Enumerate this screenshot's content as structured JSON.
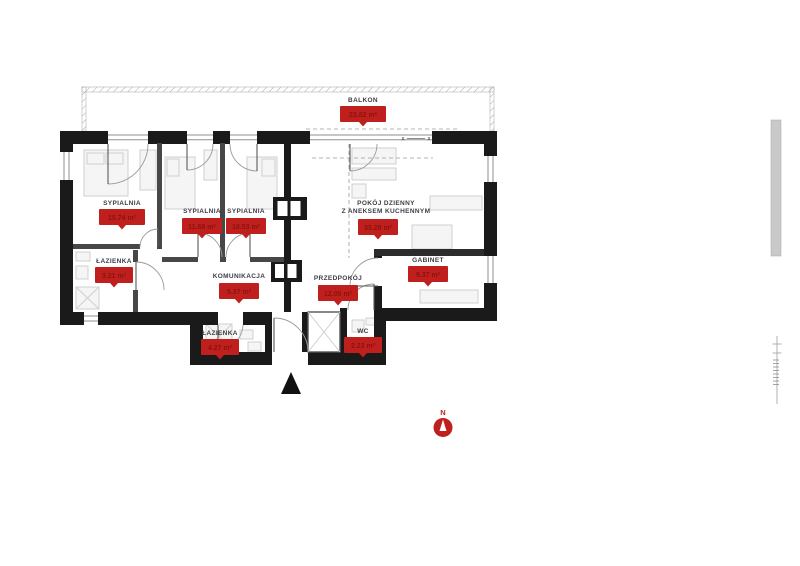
{
  "plan": {
    "colors": {
      "badge": "#c0201d",
      "badge_text": "#8a1310",
      "label_text": "#3d3d44",
      "wall": "#1a1a1a"
    },
    "rooms": [
      {
        "id": "balkon",
        "name": "BALKON",
        "area": "23.82 m²"
      },
      {
        "id": "sypialnia-1",
        "name": "SYPIALNIA",
        "area": "15.74 m²"
      },
      {
        "id": "sypialnia-2",
        "name": "SYPIALNIA",
        "area": "11.68 m²"
      },
      {
        "id": "sypialnia-3",
        "name": "SYPIALNIA",
        "area": "10.53 m²"
      },
      {
        "id": "pokoj-dzienny",
        "name_line1": "POKÓJ DZIENNY",
        "name_line2": "Z ANEKSEM KUCHENNYM",
        "area": "33.28 m²"
      },
      {
        "id": "lazienka-1",
        "name": "ŁAZIENKA",
        "area": "3.21 m²"
      },
      {
        "id": "komunikacja",
        "name": "KOMUNIKACJA",
        "area": "5.37 m²"
      },
      {
        "id": "przedpokoj",
        "name": "PRZEDPOKÓJ",
        "area": "12.05 m²"
      },
      {
        "id": "gabinet",
        "name": "GABINET",
        "area": "9.37 m²"
      },
      {
        "id": "lazienka-2",
        "name": "ŁAZIENKA",
        "area": "4.27 m²"
      },
      {
        "id": "wc",
        "name": "WC",
        "area": "2.23 m²"
      }
    ],
    "compass": {
      "label": "N"
    },
    "glazing_marks": {
      "left": "x",
      "right": "x"
    }
  }
}
